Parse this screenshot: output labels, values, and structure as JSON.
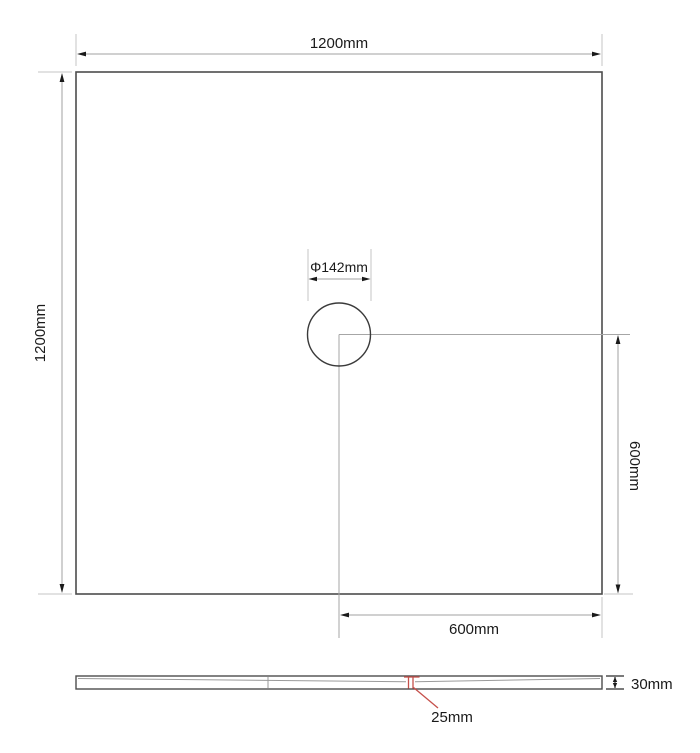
{
  "drawing": {
    "plan": {
      "width_label": "1200mm",
      "height_label": "1200mm",
      "drain_diameter_label": "Φ142mm",
      "drain_offset_vertical_label": "600mm",
      "drain_offset_horizontal_label": "600mm"
    },
    "profile": {
      "thickness_label": "30mm",
      "drain_detail_label": "25mm"
    },
    "colors": {
      "background": "#ffffff",
      "outline": "#4d4d4d",
      "dimension_line": "#a0a0a0",
      "extension_line": "#c4c4c4",
      "text": "#1a1a1a",
      "accent_red": "#c6504b"
    }
  }
}
